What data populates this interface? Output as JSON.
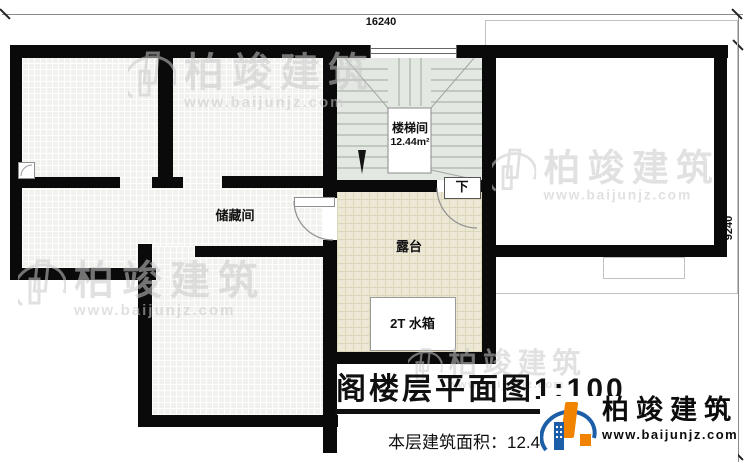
{
  "dimensions": {
    "top": "16240",
    "right": "9240"
  },
  "rooms": [
    {
      "id": "storage",
      "label": "储藏间"
    },
    {
      "id": "stairwell",
      "label": "楼梯间",
      "area": "12.44m²"
    },
    {
      "id": "terrace",
      "label": "露台"
    },
    {
      "id": "water_tank",
      "label": "2T 水箱"
    }
  ],
  "stair": {
    "direction_label": "下"
  },
  "title_block": {
    "title": "阁楼层平面图1:100",
    "area_line": "本层建筑面积：12.44m²"
  },
  "brand": {
    "name": "柏竣建筑",
    "url": "www.baijunjz.com"
  },
  "watermark": {
    "name": "柏竣建筑",
    "url": "www.baijunjz.com"
  },
  "colors": {
    "wall": "#0a0a0a",
    "tile_floor": "#f1f1ee",
    "terrace_floor": "#ece8d5",
    "stair_floor": "#e3e8e2",
    "brand_orange": "#f08300",
    "brand_blue": "#1c5fa8"
  }
}
